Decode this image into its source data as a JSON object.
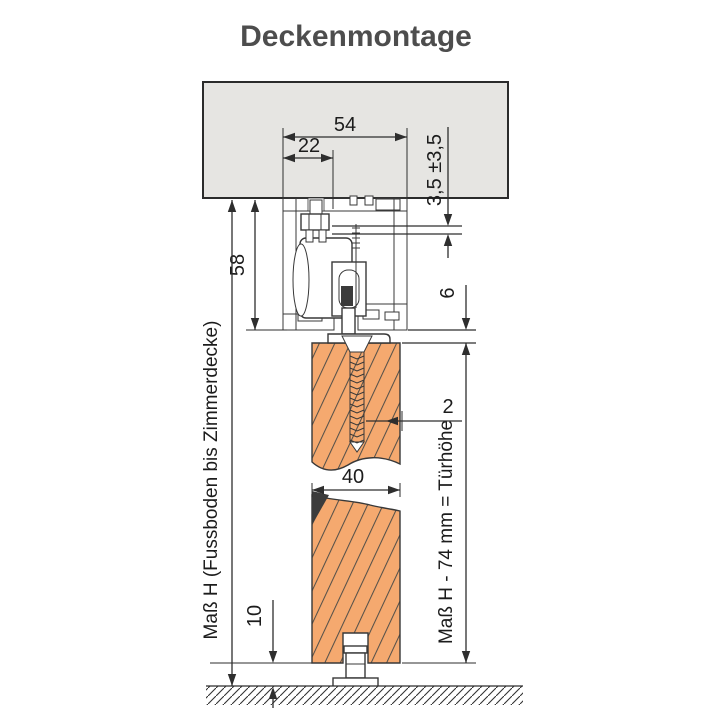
{
  "title": "Deckenmontage",
  "labels": {
    "dim_track_width": "54",
    "dim_bolt_offset": "22",
    "dim_adjustment": "3,5 ±3,5",
    "dim_track_height": "58",
    "dim_clearance": "6",
    "dim_screw": "2",
    "dim_door_thickness": "40",
    "dim_floor_gap": "10",
    "dim_height_left": "Maß H (Fussboden bis Zimmerdecke)",
    "dim_height_right": "Maß H - 74 mm = Türhöhe"
  },
  "colors": {
    "title": "#4d4d4d",
    "ceiling_fill": "#e6e5e2",
    "door_fill": "#f5a96f",
    "seal_fill": "#3c3c3c",
    "line": "#2e2e2e"
  }
}
